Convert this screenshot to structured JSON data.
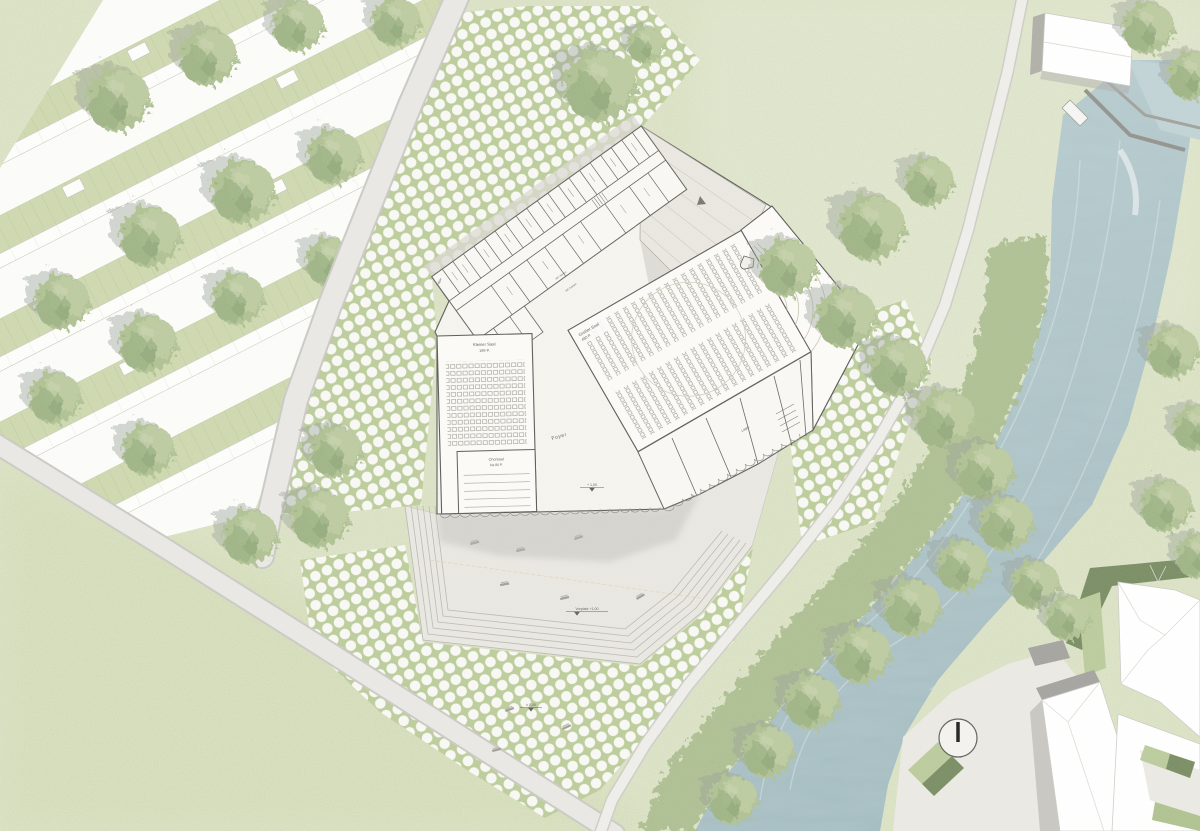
{
  "meta": {
    "kind": "architectural-site-plan",
    "view": "ground-floor / Lageplan"
  },
  "plan": {
    "rooms": {
      "kleiner_saal": {
        "name": "Kleiner Saal",
        "capacity": "199 P."
      },
      "chorsaal": {
        "name": "Chorsaal",
        "capacity": "bis 80 P."
      },
      "grosser_saal": {
        "name": "Großer Saal",
        "capacity": "480 P."
      },
      "foyer": {
        "name": "Foyer"
      },
      "lager_nw": {
        "name": "Lager"
      },
      "lager_se": {
        "name": "Lager"
      },
      "wc_herren": {
        "name": "WC Herren"
      },
      "wc_damen": {
        "name": "WC Damen"
      }
    },
    "levels": {
      "entry": "+ 1,00",
      "vorplatz": "Vorplatz +1,00",
      "ground": "± 0,00"
    }
  },
  "colors": {
    "meadow": "#cbd5ad",
    "meadow_dark": "#c3cf9f",
    "meadow_light": "#d3dcba",
    "estate_ground": "#fbfbf9",
    "garden": "#cad5a9",
    "paving_green": "#b7c893",
    "dot": "#f7f7f4",
    "road": "#e7e6e2",
    "road_edge": "#c6c5c0",
    "plaza": "#e7e5df",
    "building": "#f4f3ee",
    "room": "#fbfaf7",
    "wall": "#4f4e49",
    "roof_band": "#d8d6d0",
    "shadow": "#b3b2ae",
    "water_top": "#b6cbce",
    "water_bottom": "#9cb6bc",
    "bank_band": "#a3b786",
    "tree": "#a9bc8b",
    "hedge_dark": "#6f8458",
    "hedge_light": "#b5c795"
  }
}
